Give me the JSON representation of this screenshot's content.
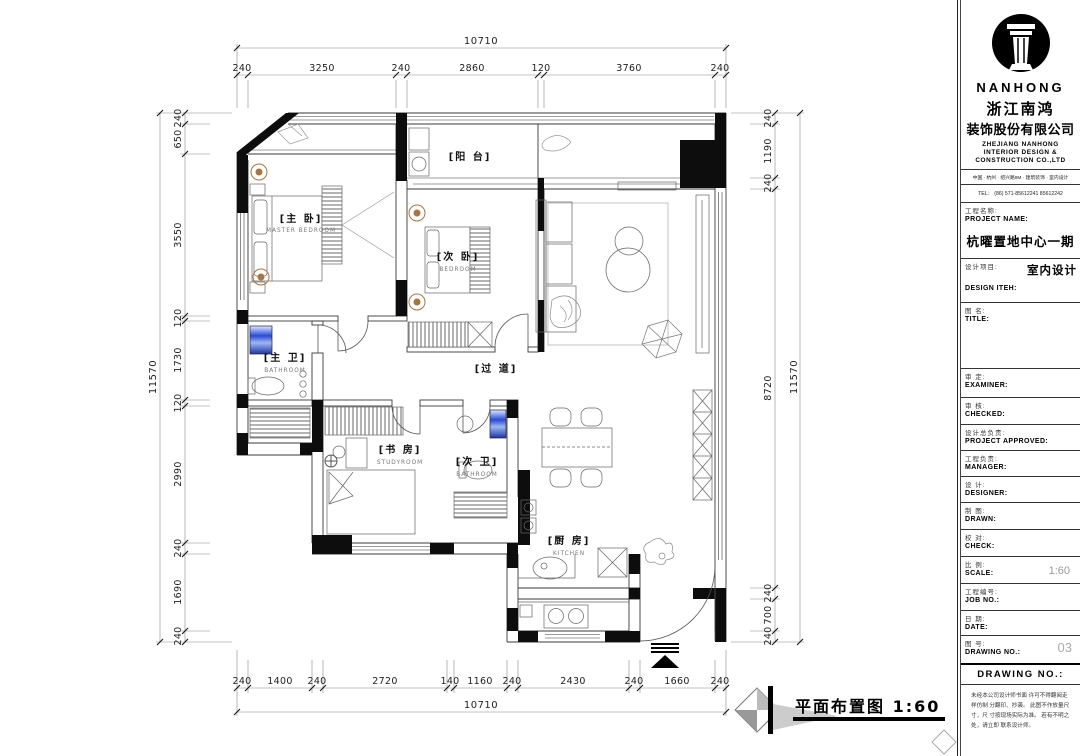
{
  "plan": {
    "caption": "平面布置图 1:60",
    "rooms": {
      "master": {
        "cn": "[主 卧]",
        "en": "MASTER BEDROOM"
      },
      "second": {
        "cn": "[次 卧]",
        "en": "BEDROOM"
      },
      "balcony": {
        "cn": "[阳 台]",
        "en": ""
      },
      "master_bath": {
        "cn": "[主 卫]",
        "en": "BATHROOM"
      },
      "corridor": {
        "cn": "[过 道]",
        "en": ""
      },
      "study": {
        "cn": "[书 房]",
        "en": "STUDYROOM"
      },
      "second_bath": {
        "cn": "[次 卫]",
        "en": "BATHROOM"
      },
      "kitchen": {
        "cn": "[厨 房]",
        "en": "KITCHEN"
      }
    }
  },
  "dims": {
    "top": {
      "overall": "10710",
      "segments": [
        "240",
        "3250",
        "240",
        "2860",
        "120",
        "3760",
        "240"
      ]
    },
    "bottom": {
      "overall": "10710",
      "segments": [
        "240",
        "1400",
        "240",
        "2720",
        "140",
        "1160",
        "240",
        "2430",
        "240",
        "1660",
        "240"
      ]
    },
    "left": {
      "overall": "11570",
      "segments": [
        "240",
        "650",
        "3550",
        "120",
        "1730",
        "120",
        "2990",
        "240",
        "1690",
        "240"
      ]
    },
    "right": {
      "overall": "11570",
      "segments": [
        "240",
        "1190",
        "240",
        "8720",
        "240",
        "700",
        "240"
      ]
    }
  },
  "title_block": {
    "brand": "NANHONG",
    "company_cn_1": "浙江南鸿",
    "company_cn_2": "装饰股份有限公司",
    "company_en_1": "ZHEJIANG NANHONG",
    "company_en_2": "INTERIOR DESIGN &",
    "company_en_3": "CONSTRUCTION CO.,LTD",
    "address": "中国 · 杭州 · 绍兴路9M · 建筑装饰 · 室内设计",
    "tel": "TEL：  (86) 571-85612241   85612242",
    "fields": [
      {
        "cn": "工程名称:",
        "en": "PROJECT NAME:",
        "value": "杭曜置地中心一期"
      },
      {
        "cn": "设计项目:",
        "en": "DESIGN ITEH:",
        "value": "室内设计"
      },
      {
        "cn": "图  名:",
        "en": "TITLE:",
        "value": ""
      },
      {
        "cn": "审  定:",
        "en": "EXAMINER:",
        "value": ""
      },
      {
        "cn": "审  核:",
        "en": "CHECKED:",
        "value": ""
      },
      {
        "cn": "设计总负责:",
        "en": "PROJECT APPROVED:",
        "value": ""
      },
      {
        "cn": "工程负责:",
        "en": "MANAGER:",
        "value": ""
      },
      {
        "cn": "设  计:",
        "en": "DESIGNER:",
        "value": ""
      },
      {
        "cn": "制  图:",
        "en": "DRAWN:",
        "value": ""
      },
      {
        "cn": "校  对:",
        "en": "CHECK:",
        "value": ""
      },
      {
        "cn": "比  例:",
        "en": "SCALE:",
        "value": "1:60"
      },
      {
        "cn": "工程编号:",
        "en": "JOB  NO.:",
        "value": ""
      },
      {
        "cn": "日  期:",
        "en": "DATE:",
        "value": ""
      },
      {
        "cn": "图  号:",
        "en": "DRAWING NO.:",
        "value": "03"
      }
    ],
    "drawing_no_header": "DRAWING NO.:",
    "disclaimer_lines": "未经本公司设计师书面 许可不得翻阅走样仿制 分翻印、抄袭。 此图不作放量尺寸，尺 寸按现场实际为准。 若有不明之处，请立即 联系设计师。"
  }
}
